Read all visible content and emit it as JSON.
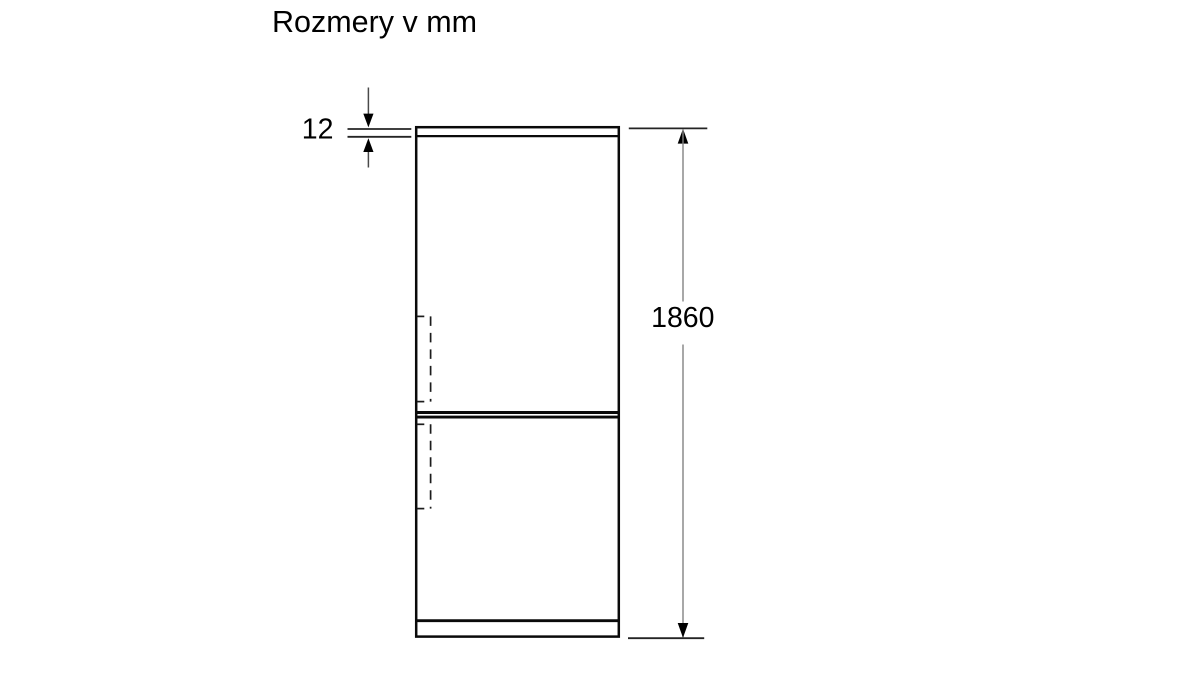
{
  "title": "Rozmery v mm",
  "unit": "mm",
  "dimensions": {
    "top_panel_thickness": {
      "value": "12",
      "unit": "mm",
      "describes": "appliance top panel thickness"
    },
    "overall_height": {
      "value": "1860",
      "unit": "mm",
      "describes": "overall appliance height"
    }
  },
  "diagram": {
    "type": "technical-dimension-drawing",
    "subject": "fridge-freezer front elevation with two doors, dashed handle recesses and plinth"
  },
  "colors": {
    "background": "#ffffff",
    "outline": "#0a0a0a",
    "extension_line": "#242424",
    "dimension_shaft_short": "#4a4a4a",
    "dimension_shaft_long": "#838383",
    "arrowhead": "#000000",
    "text": "#000000"
  }
}
